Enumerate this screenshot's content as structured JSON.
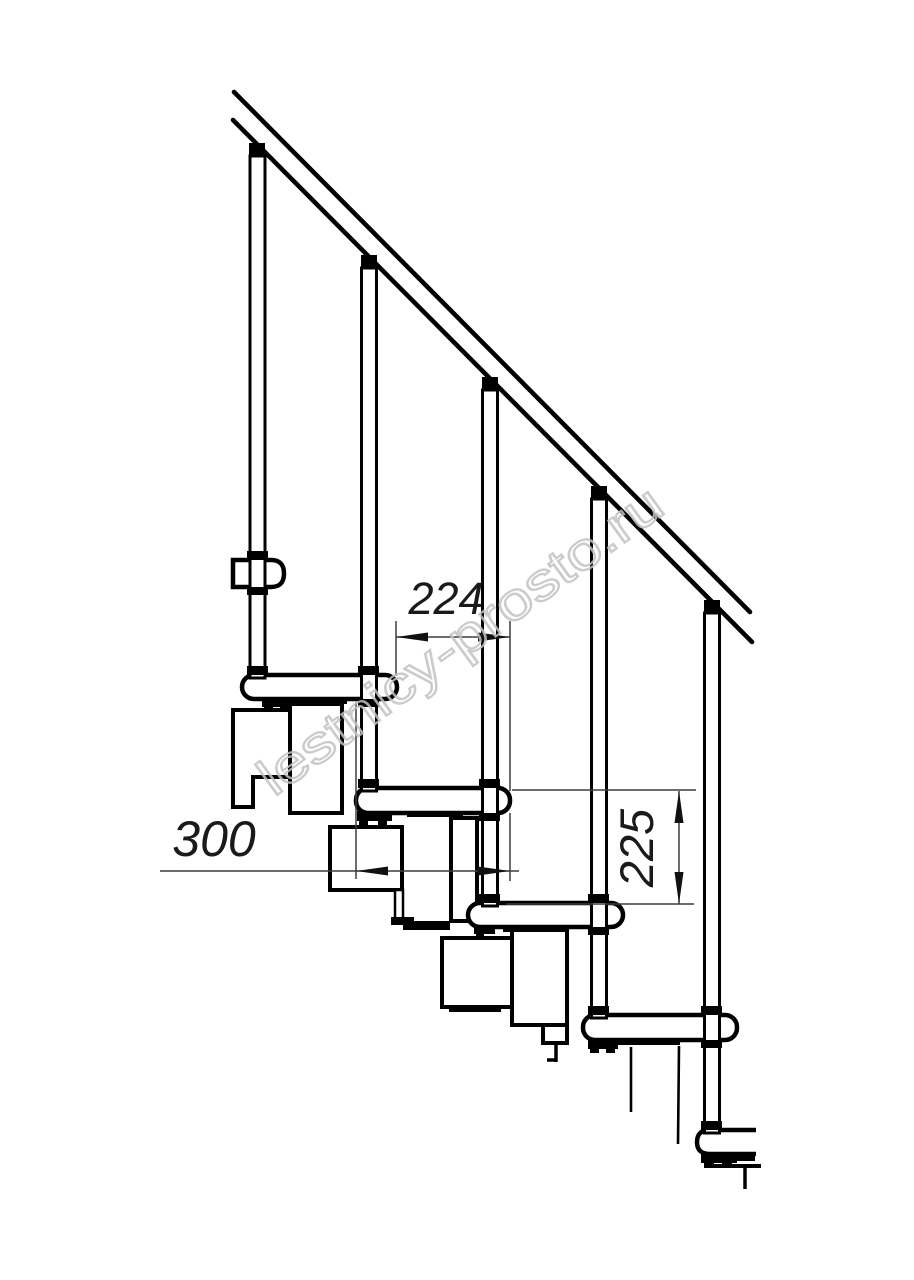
{
  "drawing": {
    "kind": "modular-staircase-side-view-line-drawing",
    "background": "#ffffff",
    "ink": "#000000",
    "dimension_ink": "#3d3d3d"
  },
  "dimensions": {
    "tread_run": "224",
    "tread_depth": "300",
    "step_rise": "225"
  },
  "watermark": {
    "text": "lestnicy-prosto.ru",
    "color": "#c3c3c3"
  },
  "structure": {
    "balusters_count": "5",
    "treads_count": "6"
  }
}
